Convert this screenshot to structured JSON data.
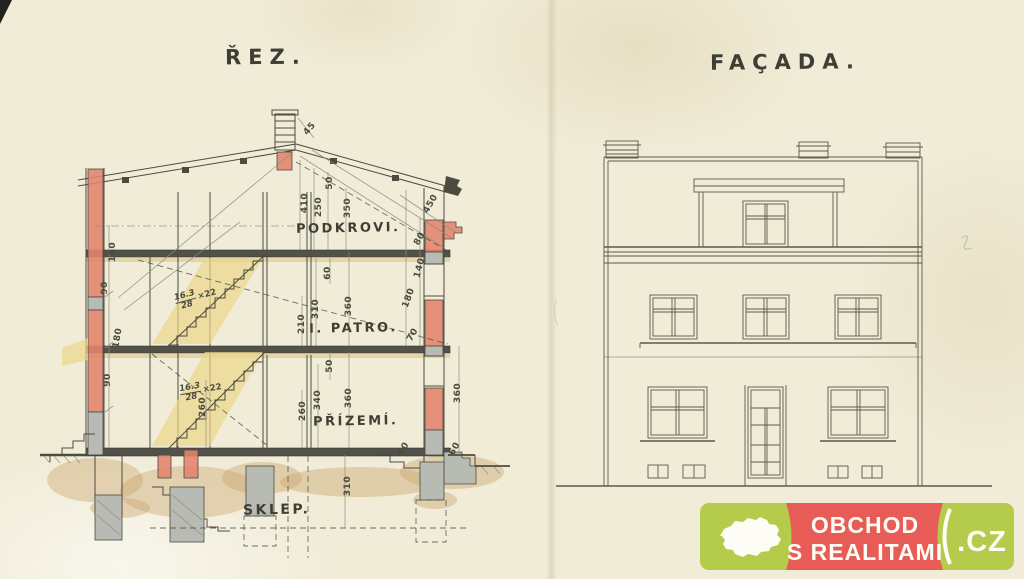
{
  "palette": {
    "paper": "#f1ecd8",
    "ink": "#4b4b40",
    "wall_red": "#e2836b",
    "stair_yellow": "#ecd78c",
    "concrete_gray": "#b7bbb4",
    "earth_tan": "#c9a368",
    "logo_green": "#b4cb4b",
    "logo_red": "#e85c57"
  },
  "section": {
    "title": "ŘEZ.",
    "floor_labels": [
      {
        "text": "PODKROVI.",
        "x": 296,
        "y": 221,
        "size": 13
      },
      {
        "text": "I. PATRO.",
        "x": 309,
        "y": 321,
        "size": 13
      },
      {
        "text": "PŘÍZEMÍ.",
        "x": 313,
        "y": 414,
        "size": 13
      },
      {
        "text": "SKLEP.",
        "x": 243,
        "y": 502,
        "size": 14
      }
    ],
    "dimensions": [
      {
        "t": "45",
        "x": 310,
        "y": 129,
        "r": -50
      },
      {
        "t": "410",
        "x": 305,
        "y": 203,
        "r": -90
      },
      {
        "t": "250",
        "x": 319,
        "y": 207,
        "r": -90
      },
      {
        "t": "50",
        "x": 330,
        "y": 183,
        "r": -90
      },
      {
        "t": "350",
        "x": 348,
        "y": 208,
        "r": -90
      },
      {
        "t": "450",
        "x": 431,
        "y": 204,
        "r": -60
      },
      {
        "t": "180",
        "x": 113,
        "y": 252,
        "r": -90
      },
      {
        "t": "90",
        "x": 105,
        "y": 288,
        "r": -90
      },
      {
        "t": "180",
        "x": 118,
        "y": 338,
        "r": -80
      },
      {
        "t": "90",
        "x": 108,
        "y": 380,
        "r": -90
      },
      {
        "t": "80",
        "x": 420,
        "y": 239,
        "r": -60
      },
      {
        "t": "140",
        "x": 420,
        "y": 268,
        "r": -75
      },
      {
        "t": "60",
        "x": 328,
        "y": 273,
        "r": -90
      },
      {
        "t": "310",
        "x": 316,
        "y": 309,
        "r": -90
      },
      {
        "t": "360",
        "x": 349,
        "y": 306,
        "r": -90
      },
      {
        "t": "210",
        "x": 302,
        "y": 324,
        "r": -90
      },
      {
        "t": "180",
        "x": 409,
        "y": 298,
        "r": -70
      },
      {
        "t": "70",
        "x": 413,
        "y": 335,
        "r": -60
      },
      {
        "t": "50",
        "x": 330,
        "y": 366,
        "r": -90
      },
      {
        "t": "260",
        "x": 303,
        "y": 411,
        "r": -90
      },
      {
        "t": "340",
        "x": 318,
        "y": 400,
        "r": -90
      },
      {
        "t": "360",
        "x": 349,
        "y": 398,
        "r": -90
      },
      {
        "t": "260",
        "x": 203,
        "y": 407,
        "r": -90
      },
      {
        "t": "360",
        "x": 458,
        "y": 393,
        "r": -90
      },
      {
        "t": "60",
        "x": 404,
        "y": 449,
        "r": -60
      },
      {
        "t": "60",
        "x": 455,
        "y": 449,
        "r": -60
      },
      {
        "t": "310",
        "x": 348,
        "y": 486,
        "r": -90
      }
    ],
    "stair_notes": [
      {
        "num": "16.3",
        "den": "28",
        "mult": "×22",
        "x": 196,
        "y": 298,
        "r": -15
      },
      {
        "num": "16.3",
        "den": "28",
        "mult": "×22",
        "x": 201,
        "y": 391,
        "r": -10
      }
    ]
  },
  "facade": {
    "title": "FAÇADA."
  },
  "logo": {
    "line1": "OBCHOD",
    "line2": "S REALITAMI",
    "suffix": ".CZ"
  }
}
